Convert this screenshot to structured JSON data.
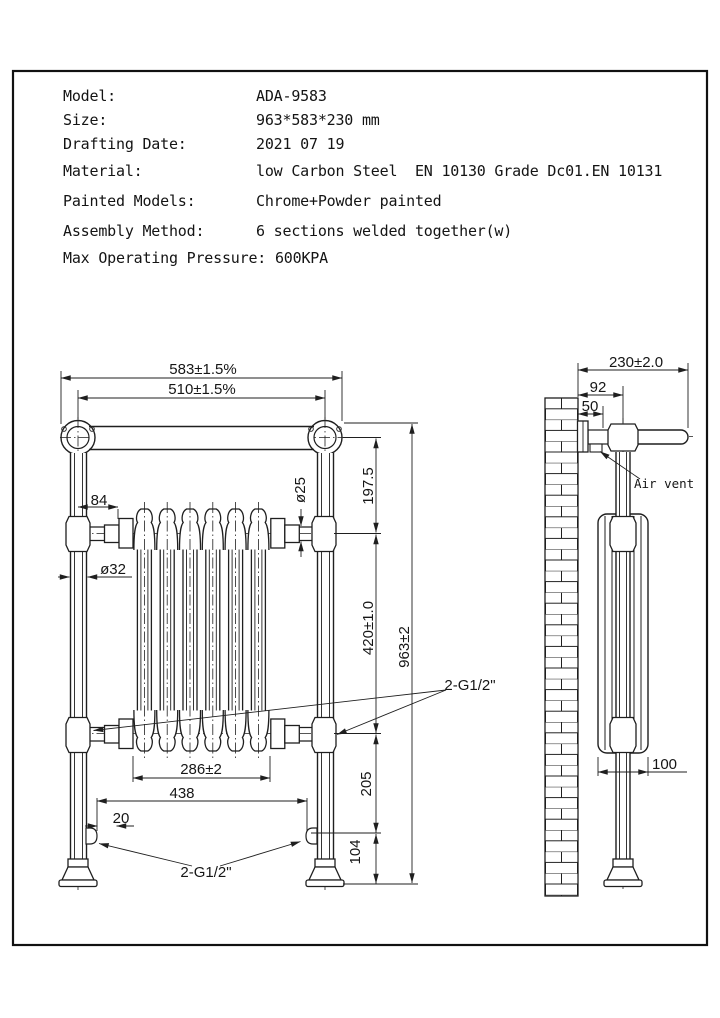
{
  "spec_table": {
    "rows": [
      {
        "label": "Model:",
        "value": "ADA-9583"
      },
      {
        "label": "Size:",
        "value": "963*583*230 mm"
      },
      {
        "label": "Drafting Date:",
        "value": "2021 07 19"
      },
      {
        "label": "Material:",
        "value": "low Carbon Steel  EN 10130 Grade Dc01.EN 10131"
      },
      {
        "label": "Painted Models:",
        "value": "Chrome+Powder painted"
      },
      {
        "label": "Assembly Method:",
        "value": "6 sections welded together(w)"
      },
      {
        "label": "Max Operating Pressure:",
        "value": "600KPA"
      }
    ]
  },
  "front_view": {
    "dim_overall_width": "583±1.5%",
    "dim_rail_length": "510±1.5%",
    "dim_top_to_radiator": "197.5",
    "dim_rail_diameter": "ø25",
    "dim_radiator_offset": "84",
    "dim_post_diameter": "ø32",
    "dim_radiator_height": "420±1.0",
    "dim_overall_height": "963±2",
    "dim_radiator_width": "286±2",
    "dim_inlet_span": "438",
    "dim_inlet_stub": "20",
    "dim_radiator_to_inlet": "205",
    "dim_inlet_height": "104",
    "label_connections": "2-G1/2\"",
    "label_inlets": "2-G1/2\""
  },
  "side_view": {
    "dim_overall_depth": "230±2.0",
    "dim_wall_to_post": "92",
    "dim_wall_to_bracket": "50",
    "dim_radiator_depth": "100",
    "label_air_vent": "Air vent"
  },
  "colors": {
    "line": "#1f1f1f",
    "background": "#ffffff"
  }
}
